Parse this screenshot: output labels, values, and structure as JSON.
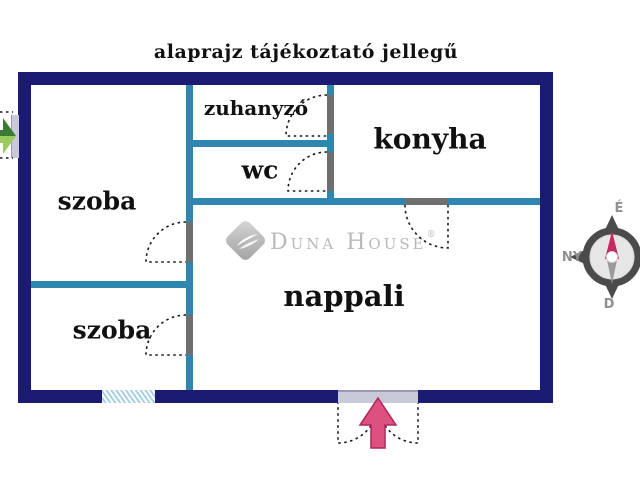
{
  "title": "alaprajz tájékoztató jellegű",
  "rooms": [
    {
      "id": "szoba-felso",
      "label": "szoba"
    },
    {
      "id": "zuhanyzo",
      "label": "zuhanyzó"
    },
    {
      "id": "wc",
      "label": "wc"
    },
    {
      "id": "konyha",
      "label": "konyha"
    },
    {
      "id": "szoba-also",
      "label": "szoba"
    },
    {
      "id": "nappali",
      "label": "nappali"
    }
  ],
  "watermark": {
    "brand": "Duna House",
    "registered": "®",
    "icon": "duna-house-diamond-wave-icon"
  },
  "compass": {
    "north_label": "É",
    "west_label": "NY",
    "south_label": "D"
  },
  "markers": {
    "main_entrance": "pink-arrow-up-double-door",
    "side_entrance": "green-arrow-right"
  },
  "colors": {
    "outer-wall": "#1b1b73",
    "inner-wall": "#2f86ae",
    "door-jamb": "#6f6f6f",
    "door-opening": "#c9cad8",
    "window-hatch": "#a9cfe2",
    "label-ink": "#111111",
    "dash-ink": "#1a1a1a",
    "logo-gray": "#b9b9b9",
    "compass-ring": "#4b4b4b",
    "compass-letter": "#8f8f8f",
    "needle-north": "#c72a62",
    "needle-south": "#9b9b9b",
    "arrow-pink": "#dd5181",
    "arrow-pink-edge": "#b0255c",
    "arrow-green-dark": "#3a7a33",
    "arrow-green-light": "#9ccb5f"
  }
}
